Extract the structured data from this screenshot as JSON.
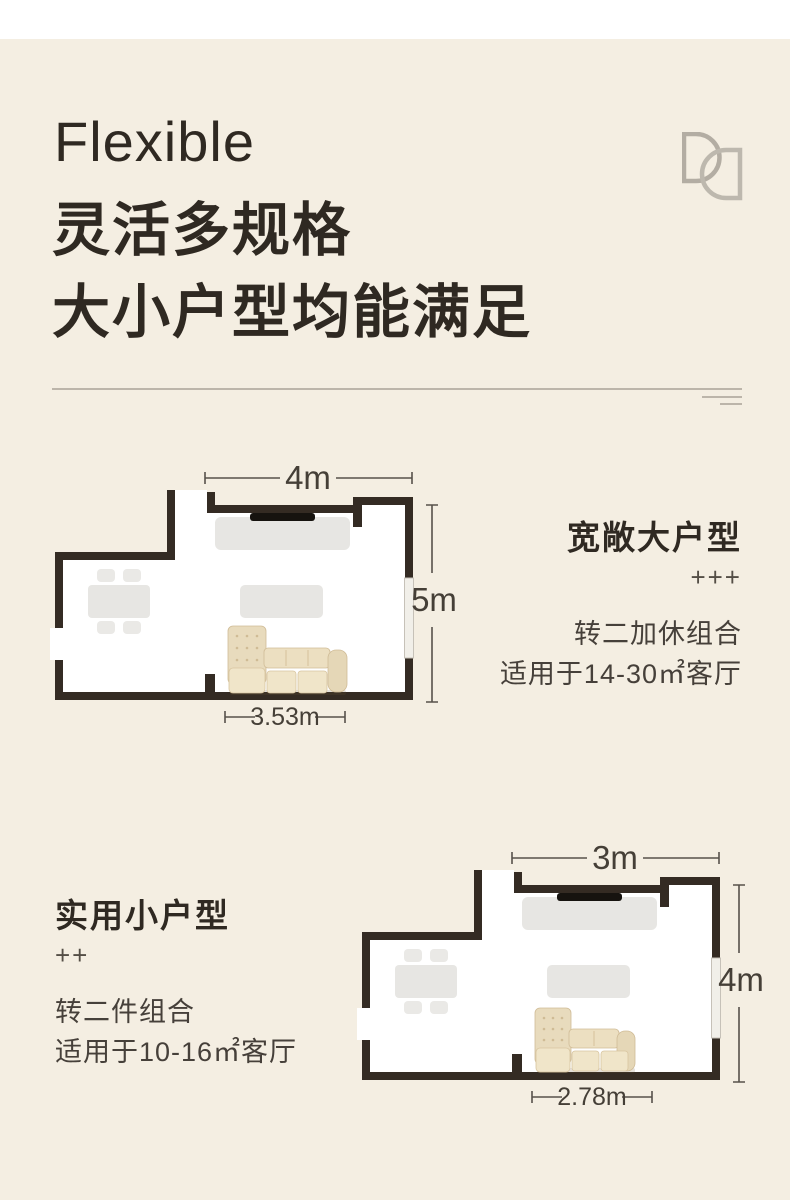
{
  "header": {
    "title_en": "Flexible",
    "title_zh_line1": "灵活多规格",
    "title_zh_line2": "大小户型均能满足",
    "logo_icon": "overlapping-dd-logo"
  },
  "plans": [
    {
      "name": "宽敞大户型",
      "rating": "+++",
      "combo": "转二加休组合",
      "suitable": "适用于14-30㎡客厅",
      "width_label": "4m",
      "height_label": "5m",
      "sofa_label": "3.53m"
    },
    {
      "name": "实用小户型",
      "rating": "++",
      "combo": "转二件组合",
      "suitable": "适用于10-16㎡客厅",
      "width_label": "3m",
      "height_label": "4m",
      "sofa_label": "2.78m"
    }
  ],
  "colors": {
    "background": "#f4eee2",
    "top_band": "#ffffff",
    "wall": "#342b23",
    "room_fill": "#ffffff",
    "furniture_gray": "#e7e6e3",
    "sofa_beige": "#ecdfc1",
    "heading_text": "#2f2922",
    "body_text": "#46403a",
    "dimension_text": "#453f37",
    "divider": "#bcb5aa",
    "logo_gray": "#b3ada3",
    "tv_black": "#16130f"
  }
}
